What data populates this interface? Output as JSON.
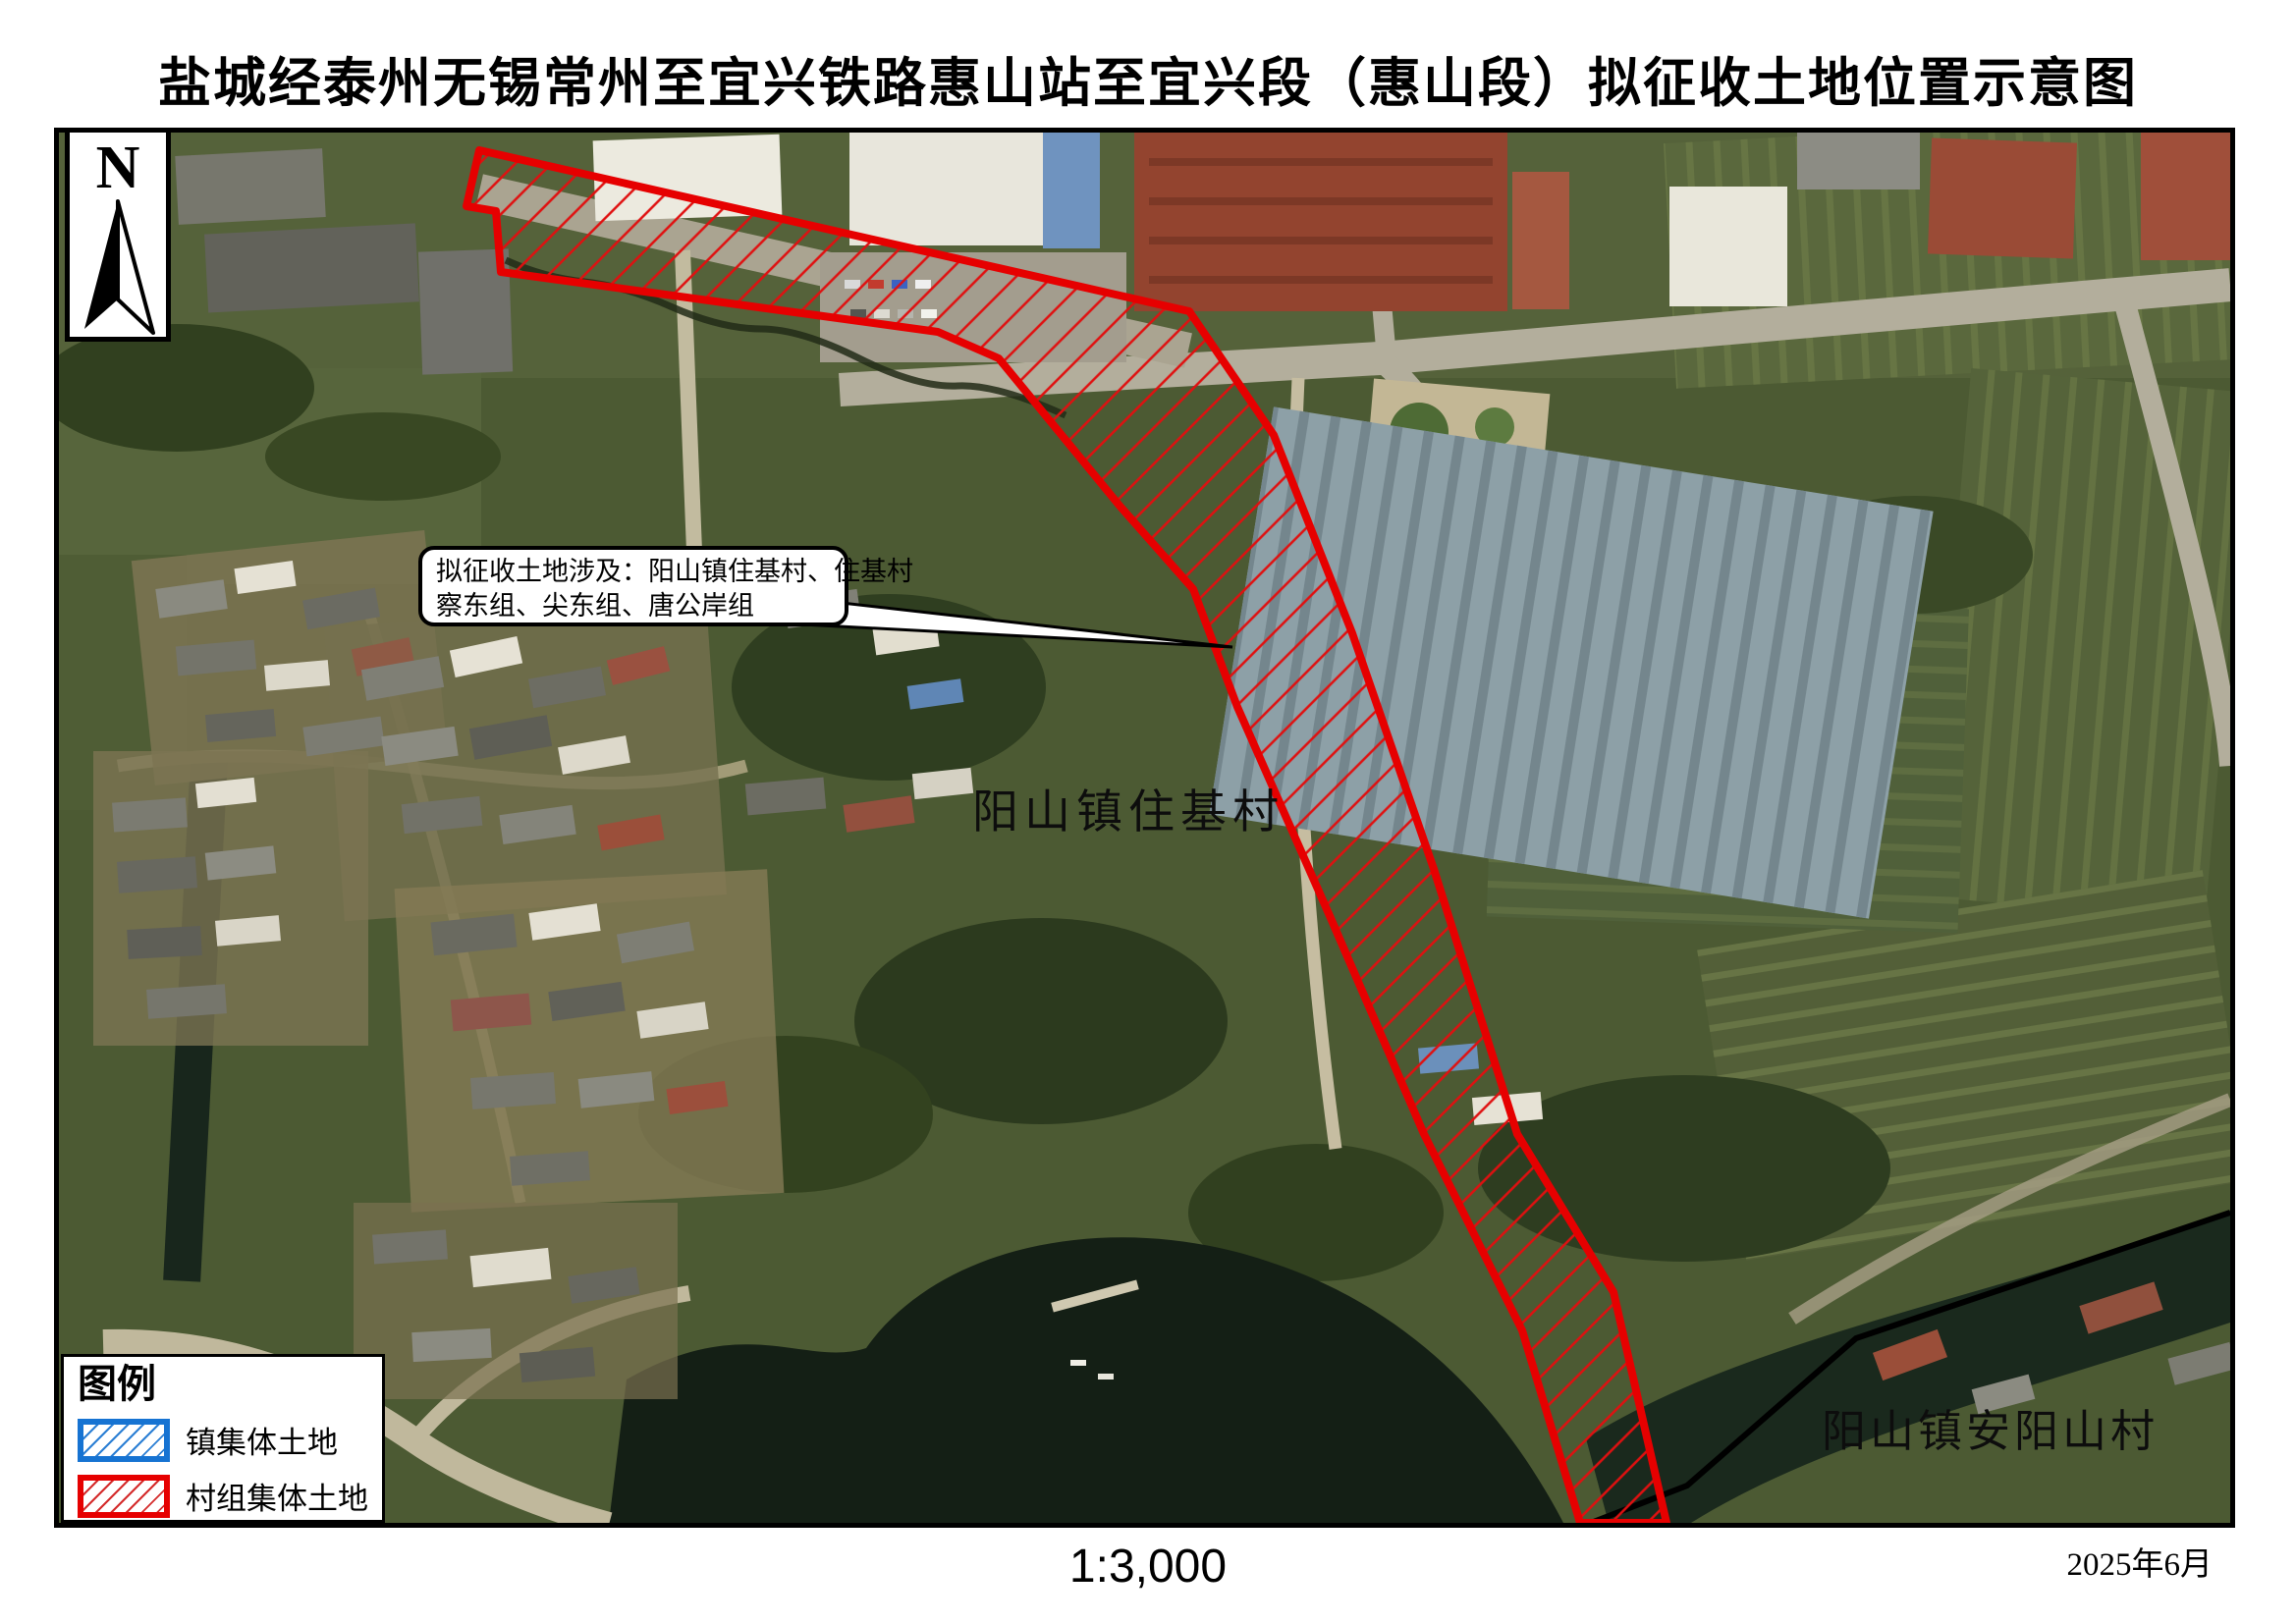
{
  "title": "盐城经泰州无锡常州至宜兴铁路惠山站至宜兴段（惠山段）拟征收土地位置示意图",
  "north": {
    "label": "N"
  },
  "callout": {
    "line1": "拟征收土地涉及：阳山镇住基村、住基村",
    "line2": "察东组、尖东组、唐公岸组"
  },
  "map_labels": {
    "village_main": "阳山镇住基村",
    "village_south": "阳山镇安阳山村"
  },
  "legend": {
    "title": "图例",
    "items": [
      {
        "label": "镇集体土地",
        "color": "#1673d2"
      },
      {
        "label": "村组集体土地",
        "color": "#e60000"
      }
    ]
  },
  "footer": {
    "scale": "1:3,000",
    "date": "2025年6月"
  },
  "colors": {
    "parcel_red": "#e60000",
    "town_blue": "#1673d2",
    "hatch_red": "#e01010",
    "boundary_black": "#000000"
  }
}
